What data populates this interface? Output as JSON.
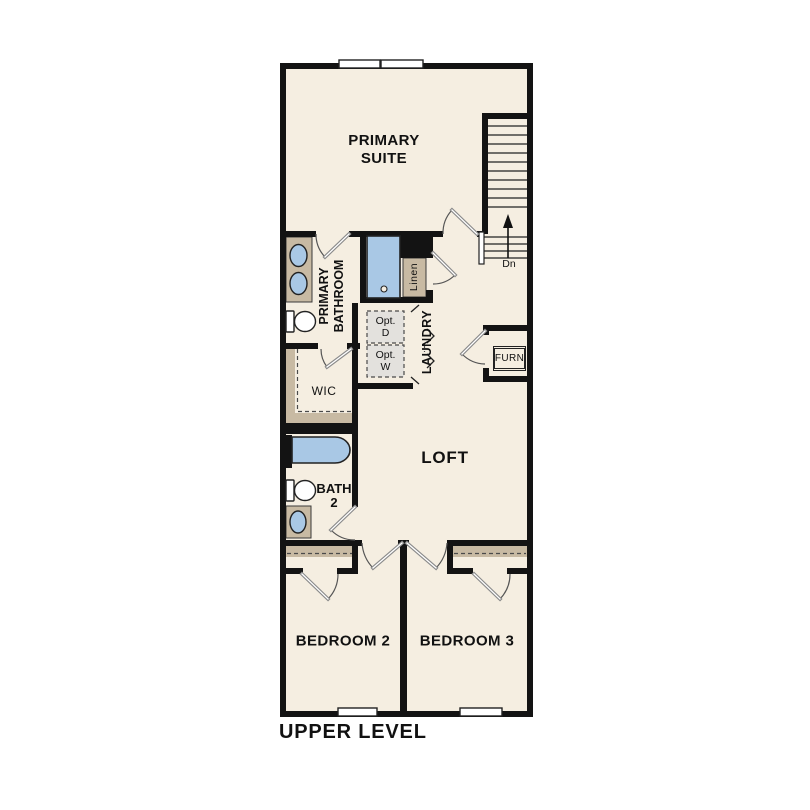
{
  "plan_title": "UPPER LEVEL",
  "colors": {
    "wall": "#131313",
    "floor": "#f5eee1",
    "counter_tan": "#c8baa3",
    "fixture_blue": "#a9c8e5",
    "optional_gray": "#e3e1dd",
    "background": "#ffffff"
  },
  "rooms": {
    "primary_suite": {
      "line1": "PRIMARY",
      "line2": "SUITE"
    },
    "primary_bathroom": {
      "line1": "PRIMARY",
      "line2": "BATHROOM"
    },
    "wic": {
      "label": "WIC"
    },
    "laundry": {
      "label": "LAUNDRY"
    },
    "linen": {
      "label": "Linen"
    },
    "furnace": {
      "label": "FURN"
    },
    "loft": {
      "label": "LOFT"
    },
    "bath2": {
      "line1": "BATH",
      "line2": "2"
    },
    "bedroom2": {
      "label": "BEDROOM 2"
    },
    "bedroom3": {
      "label": "BEDROOM 3"
    }
  },
  "stairs": {
    "direction": "Dn"
  },
  "laundry_appliances": {
    "dryer_line1": "Opt.",
    "dryer_line2": "D",
    "washer_line1": "Opt.",
    "washer_line2": "W"
  }
}
